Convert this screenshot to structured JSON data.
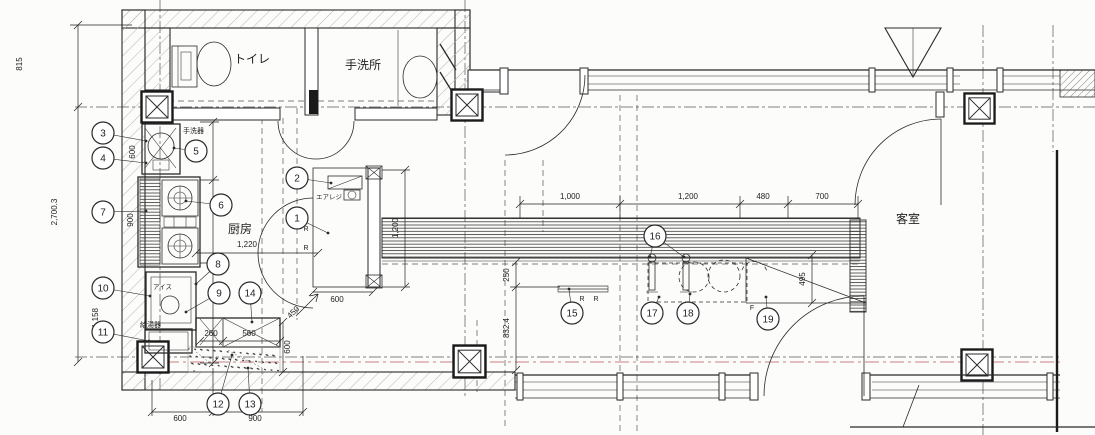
{
  "drawing": {
    "rooms": [
      {
        "id": "toilet",
        "label": "トイレ",
        "x": 252,
        "y": 63,
        "size": 12,
        "anchor": "middle"
      },
      {
        "id": "handwash",
        "label": "手洗所",
        "x": 363,
        "y": 69,
        "size": 12,
        "anchor": "middle"
      },
      {
        "id": "kitchen",
        "label": "厨房",
        "x": 240,
        "y": 233,
        "size": 12,
        "anchor": "middle"
      },
      {
        "id": "dining",
        "label": "客室",
        "x": 908,
        "y": 223,
        "size": 12,
        "anchor": "middle"
      }
    ],
    "equipment_labels": [
      {
        "id": "hand-basin",
        "label": "手洗器",
        "x": 183,
        "y": 133,
        "size": 7,
        "anchor": "start"
      },
      {
        "id": "water-heater",
        "label": "給湯器",
        "x": 140,
        "y": 327,
        "size": 7,
        "anchor": "start"
      },
      {
        "id": "ice-box",
        "label": "アイス",
        "x": 153,
        "y": 289,
        "size": 6.5,
        "anchor": "start"
      },
      {
        "id": "air-regi",
        "label": "エアレジ",
        "x": 316,
        "y": 199,
        "size": 6.5,
        "anchor": "start"
      }
    ],
    "callouts": [
      {
        "n": "1",
        "x": 297,
        "y": 218,
        "lx": 328,
        "ly": 233
      },
      {
        "n": "2",
        "x": 297,
        "y": 178,
        "lx": 331,
        "ly": 183
      },
      {
        "n": "3",
        "x": 103,
        "y": 133,
        "lx": 146,
        "ly": 141
      },
      {
        "n": "4",
        "x": 103,
        "y": 158,
        "lx": 146,
        "ly": 163
      },
      {
        "n": "5",
        "x": 196,
        "y": 151,
        "lx": 174,
        "ly": 148
      },
      {
        "n": "6",
        "x": 221,
        "y": 205,
        "lx": 186,
        "ly": 201
      },
      {
        "n": "7",
        "x": 103,
        "y": 212,
        "lx": 146,
        "ly": 211
      },
      {
        "n": "8",
        "x": 218,
        "y": 264,
        "lx": 196,
        "ly": 284
      },
      {
        "n": "9",
        "x": 219,
        "y": 293,
        "lx": 186,
        "ly": 312
      },
      {
        "n": "10",
        "x": 103,
        "y": 288,
        "lx": 150,
        "ly": 296
      },
      {
        "n": "11",
        "x": 103,
        "y": 332,
        "lx": 149,
        "ly": 341
      },
      {
        "n": "12",
        "x": 218,
        "y": 404,
        "lx": 232,
        "ly": 355
      },
      {
        "n": "13",
        "x": 250,
        "y": 404,
        "lx": 248,
        "ly": 368
      },
      {
        "n": "14",
        "x": 250,
        "y": 293,
        "lx": 252,
        "ly": 322
      },
      {
        "n": "15",
        "x": 572,
        "y": 313,
        "lx": 569,
        "ly": 289
      },
      {
        "n": "16",
        "x": 655,
        "y": 236,
        "lx": 650,
        "ly": 257,
        "l2x": 684,
        "l2y": 257
      },
      {
        "n": "17",
        "x": 652,
        "y": 313,
        "lx": 659,
        "ly": 297
      },
      {
        "n": "18",
        "x": 688,
        "y": 313,
        "lx": 690,
        "ly": 294
      },
      {
        "n": "19",
        "x": 768,
        "y": 319,
        "lx": 766,
        "ly": 297
      }
    ],
    "dimensions": [
      {
        "text": "815",
        "x": 22,
        "y": 64,
        "rot": -90
      },
      {
        "text": "2,700.3",
        "x": 57,
        "y": 212,
        "rot": -90
      },
      {
        "text": "600",
        "x": 135,
        "y": 152,
        "rot": -90
      },
      {
        "text": "900",
        "x": 133,
        "y": 220,
        "rot": -90
      },
      {
        "text": "1,158",
        "x": 98,
        "y": 318,
        "rot": -90
      },
      {
        "text": "600",
        "x": 180,
        "y": 421,
        "rot": 0
      },
      {
        "text": "900",
        "x": 255,
        "y": 421,
        "rot": 0
      },
      {
        "text": "1,220",
        "x": 247,
        "y": 247,
        "rot": 0
      },
      {
        "text": "600",
        "x": 337,
        "y": 302,
        "rot": 0
      },
      {
        "text": "450",
        "x": 295,
        "y": 314,
        "rot": -45
      },
      {
        "text": "260",
        "x": 211,
        "y": 336,
        "rot": 0
      },
      {
        "text": "560",
        "x": 249,
        "y": 336,
        "rot": 0
      },
      {
        "text": "600",
        "x": 290,
        "y": 347,
        "rot": -90
      },
      {
        "text": "1,000",
        "x": 570,
        "y": 199,
        "rot": 0
      },
      {
        "text": "1,200",
        "x": 688,
        "y": 199,
        "rot": 0
      },
      {
        "text": "480",
        "x": 763,
        "y": 199,
        "rot": 0
      },
      {
        "text": "700",
        "x": 822,
        "y": 199,
        "rot": 0
      },
      {
        "text": "1,200",
        "x": 398,
        "y": 228,
        "rot": -90
      },
      {
        "text": "250",
        "x": 509,
        "y": 275,
        "rot": -90
      },
      {
        "text": "832.4",
        "x": 509,
        "y": 328,
        "rot": -90
      },
      {
        "text": "495",
        "x": 805,
        "y": 279,
        "rot": -90
      }
    ],
    "letters": [
      {
        "text": "R",
        "x": 306,
        "y": 231
      },
      {
        "text": "R",
        "x": 306,
        "y": 250
      },
      {
        "text": "R",
        "x": 582,
        "y": 301
      },
      {
        "text": "R",
        "x": 596,
        "y": 301
      },
      {
        "text": "F",
        "x": 752,
        "y": 310
      }
    ],
    "colors": {
      "line": "#2a2a2a",
      "red_grid": "#b03a3a",
      "paper": "#fcfcfa"
    }
  }
}
